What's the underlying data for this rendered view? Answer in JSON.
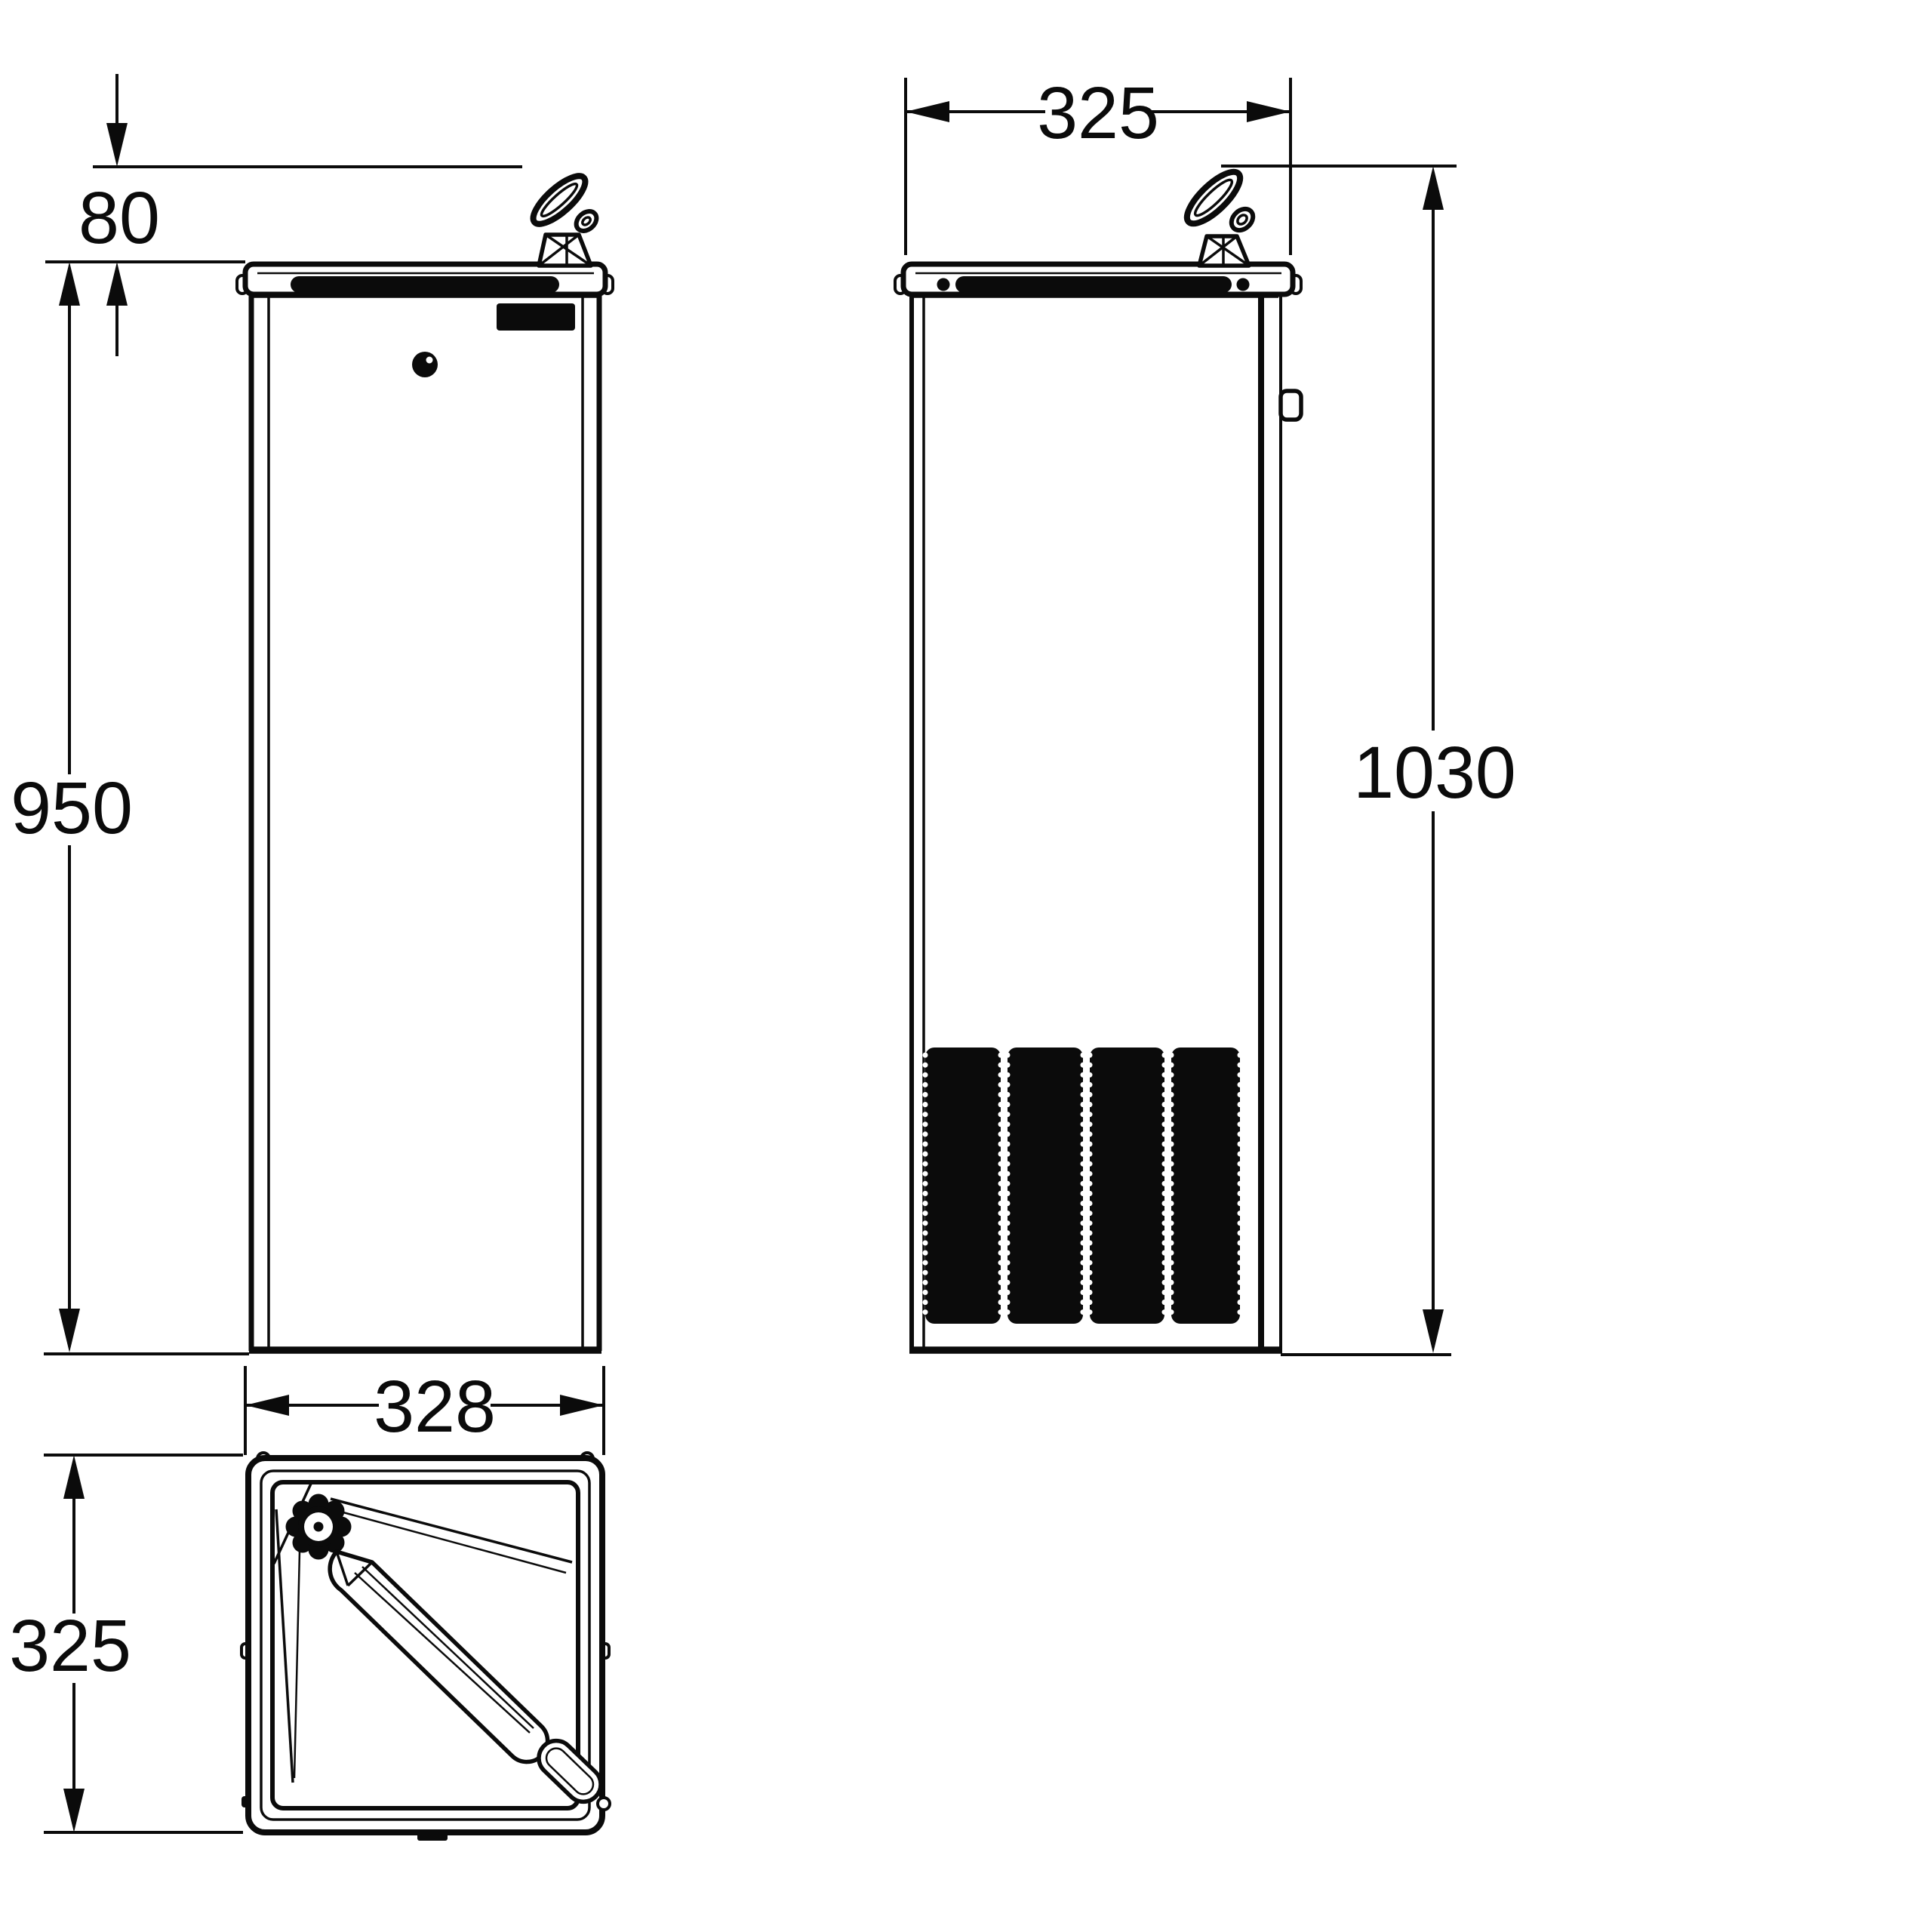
{
  "page": {
    "background": "#ffffff",
    "ink": "#0b0b0b",
    "drawing_type": "technical dimension drawing",
    "subject": "floor-standing drinking fountain with bubbler tap, three orthographic views"
  },
  "dimensions": {
    "front_spout_height": {
      "label": "80"
    },
    "front_body_height": {
      "label": "950"
    },
    "side_depth": {
      "label": "325"
    },
    "side_overall_height": {
      "label": "1030"
    },
    "plan_width": {
      "label": "328"
    },
    "plan_depth": {
      "label": "325"
    }
  }
}
